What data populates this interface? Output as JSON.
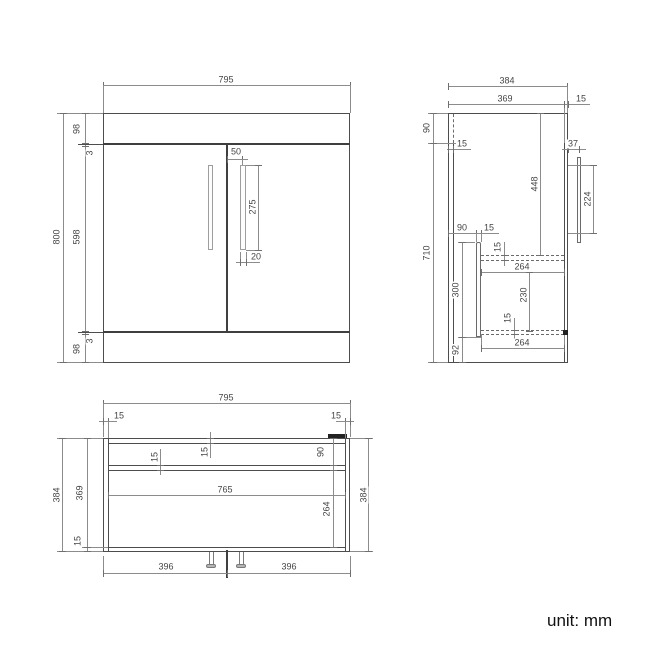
{
  "unit_label": "unit: mm",
  "front_view": {
    "width": "795",
    "total_height": "800",
    "top_panel_height": "98",
    "top_gap": "3",
    "door_height": "598",
    "bottom_gap": "3",
    "bottom_panel_height": "98",
    "handle_offset_from_center": "50",
    "handle_length": "275",
    "handle_width": "20"
  },
  "side_view": {
    "total_depth": "384",
    "body_depth": "369",
    "front_panel_thickness": "15",
    "top_section_height": "90",
    "back_panel_thickness": "15",
    "body_height": "710",
    "top_to_drawer": "448",
    "handle_standoff": "37",
    "handle_length": "224",
    "drawer_back_offset": "90",
    "drawer_back_thickness": "15",
    "drawer_top_thickness": "15",
    "drawer_top_depth": "264",
    "drawer_inner_height": "230",
    "drawer_bottom_thickness": "15",
    "drawer_bottom_depth": "264",
    "drawer_section_height": "300",
    "plinth_height": "92"
  },
  "plan_view": {
    "width": "795",
    "left_panel_thickness": "15",
    "right_panel_thickness": "15",
    "total_depth": "384",
    "inner_depth": "369",
    "front_panel_thickness": "15",
    "back_panel_thickness": "15",
    "rail_thickness": "15",
    "rail_offset": "90",
    "inner_width": "765",
    "drawer_depth": "264",
    "right_depth": "384",
    "left_door_width": "396",
    "right_door_width": "396"
  }
}
